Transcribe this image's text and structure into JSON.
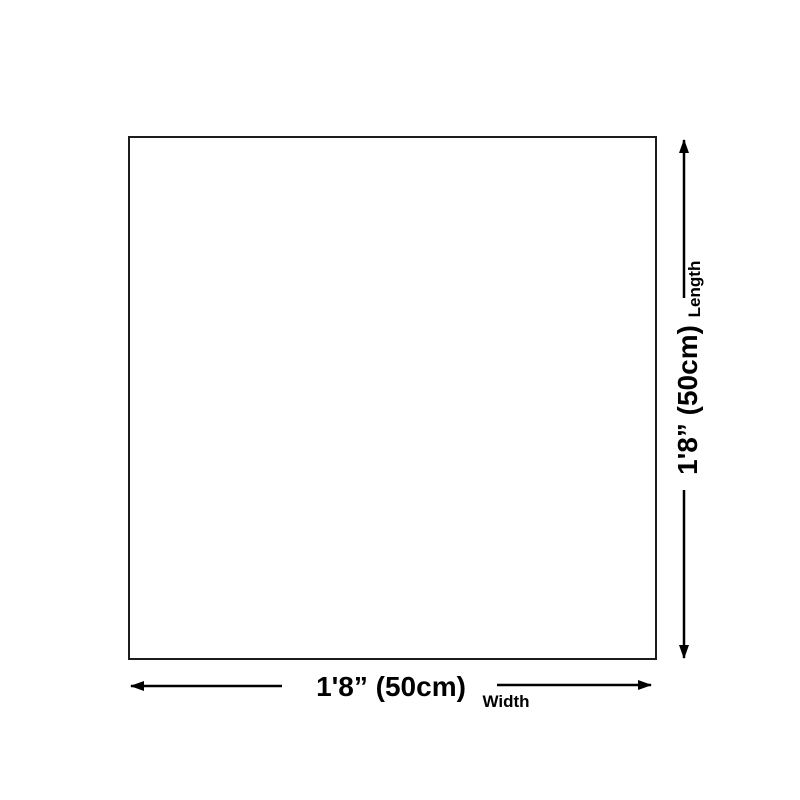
{
  "page": {
    "background_color": "#ffffff"
  },
  "diagram": {
    "outline_border_color": "#1c1c1c",
    "line_color": "#000000",
    "text_color": "#000000",
    "width_dimension": {
      "value": "1'8” (50cm)",
      "label": "Width"
    },
    "length_dimension": {
      "value": "1'8” (50cm)",
      "label": "Length"
    }
  }
}
